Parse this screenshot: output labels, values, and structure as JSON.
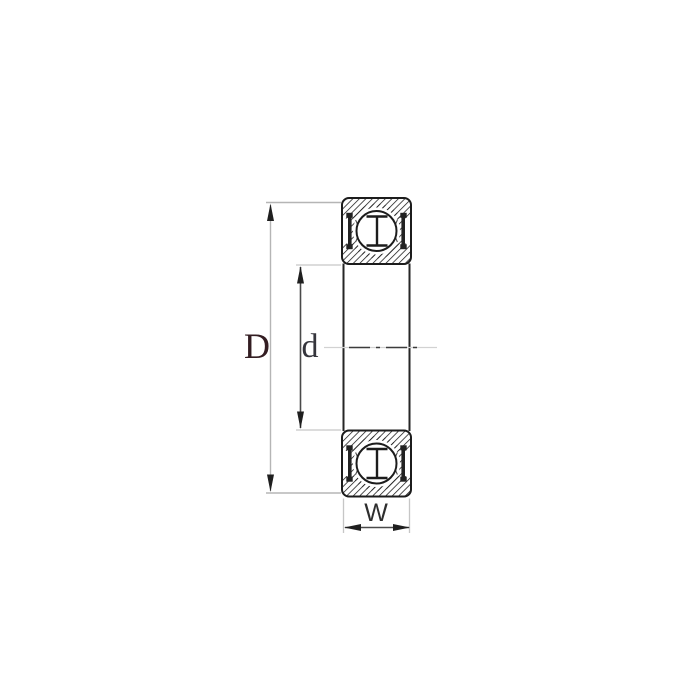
{
  "diagram": {
    "type": "deep-groove-ball-bearing-cross-section",
    "labels": {
      "outer_diameter": "D",
      "bore_diameter": "d",
      "width": "W"
    },
    "colors": {
      "background": "#ffffff",
      "drawing_line": "#1c1c1c",
      "hatch_line": "#1c1c1c",
      "seal": "#222222",
      "dim_line_light": "#b5b5b5",
      "dim_line_dark": "#4a4a4a",
      "centerline": "#3c3c3c",
      "label_D": "#331d22",
      "label_d": "#35353c",
      "label_W": "#2e2e2e"
    }
  }
}
